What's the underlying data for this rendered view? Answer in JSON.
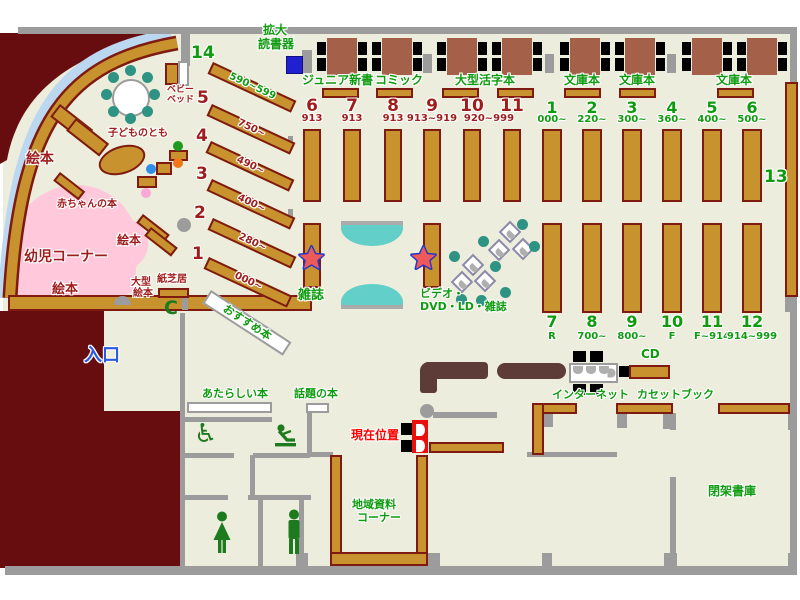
{
  "palette": {
    "floor": "#ECEDDC",
    "wall": "#9C9C9C",
    "maroon": "#670D10",
    "shelf_fill": "#C8932E",
    "shelf_border": "#7E1A10",
    "table_brown": "#A5604A",
    "teal_chair": "#2E9383",
    "bench_teal": "#63CFC9",
    "pink_area": "#FFC8DB",
    "arc_blue": "#BCD7F0",
    "label_green": "#0F9B0F",
    "label_dark_red": "#9E1C1C",
    "marker_red": "#FF0000",
    "entrance_blue": "#2A5AE0",
    "counter_brown": "#5D3C38",
    "reader_blue": "#2021CE"
  },
  "kids": {
    "num14": "14",
    "range14": "590~599",
    "shelves": [
      {
        "no": "5",
        "range": "750~"
      },
      {
        "no": "4",
        "range": "490~"
      },
      {
        "no": "3",
        "range": "400~"
      },
      {
        "no": "2",
        "range": "280~"
      },
      {
        "no": "1",
        "range": "000~"
      }
    ],
    "ehon1": "絵本",
    "ehon2": "絵本",
    "ehon3": "絵本",
    "baby_books": "赤ちゃんの本",
    "toddler_corner": "幼児コーナー",
    "kodomo_no_tomo": "子どものとも",
    "baby_bed_l1": "ベビー",
    "baby_bed_l2": "ベッド",
    "ogata_l1": "大型",
    "ogata_l2": "絵本",
    "kamishibai": "紙芝居",
    "osusume": "おすすめ本",
    "phone_icon": "C"
  },
  "top_area": {
    "kakudai_l1": "拡大",
    "kakudai_l2": "読書器",
    "junior": "ジュニア新書",
    "comic": "コミック",
    "large_print": "大型活字本",
    "bunko": [
      "文庫本",
      "文庫本",
      "文庫本"
    ]
  },
  "center": {
    "columns": [
      {
        "no": "6",
        "sub": "913"
      },
      {
        "no": "7",
        "sub": "913"
      },
      {
        "no": "8",
        "sub": "913"
      },
      {
        "no": "9",
        "sub": "913~919"
      },
      {
        "no": "10",
        "sub": ""
      },
      {
        "no": "11",
        "sub": ""
      }
    ],
    "sub_10_11": "920~999",
    "magazine": "雑誌",
    "video_l1": "ビデオ・",
    "video_l2": "DVD・LD・雑誌"
  },
  "right": {
    "top": [
      {
        "no": "1",
        "sub": "000~"
      },
      {
        "no": "2",
        "sub": "220~"
      },
      {
        "no": "3",
        "sub": "300~"
      },
      {
        "no": "4",
        "sub": "360~"
      },
      {
        "no": "5",
        "sub": "400~"
      },
      {
        "no": "6",
        "sub": "500~"
      }
    ],
    "bottom": [
      {
        "no": "7",
        "sub": "R"
      },
      {
        "no": "8",
        "sub": "700~"
      },
      {
        "no": "9",
        "sub": "800~"
      },
      {
        "no": "10",
        "sub": "F"
      },
      {
        "no": "11",
        "sub": "F~914"
      },
      {
        "no": "12",
        "sub": "914~999"
      }
    ],
    "shelf13": "13"
  },
  "bottom_area": {
    "entrance": "入口",
    "new_books": "あたらしい本",
    "topic_books": "話題の本",
    "current_pos": "現在位置",
    "internet": "インターネット",
    "cd": "CD",
    "cassette": "カセットブック",
    "local_l1": "地域資料",
    "local_l2": "コーナー",
    "closed_stacks": "閉架書庫"
  }
}
